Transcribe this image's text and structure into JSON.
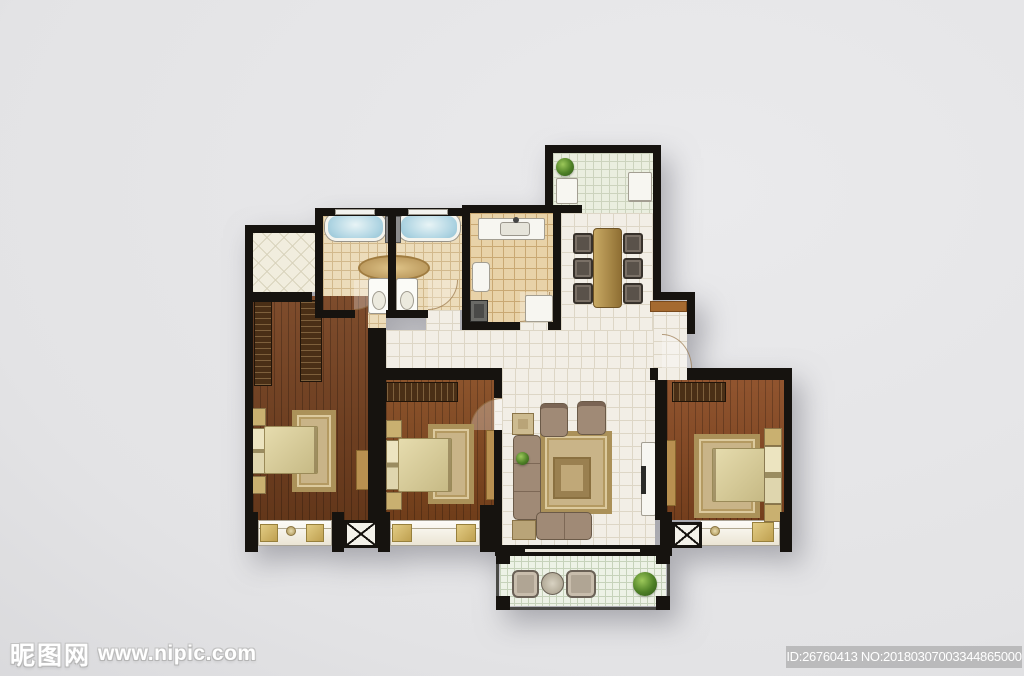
{
  "watermarks": {
    "site_name": "昵图网",
    "site_url": "www.nipic.com",
    "image_id": "ID:26760413 NO:20180307003344865000"
  },
  "colors": {
    "background": "#e4e4e6",
    "wall": "#16130f",
    "public_tile": "#f2eee6",
    "kitchen_floor": "#e8d2a8",
    "bath_floor": "#ecdcba",
    "balcony_floor": "#edf2e6",
    "wood_floor_left": "#76411f",
    "wood_floor_middle": "#85491f",
    "wood_floor_right": "#8a4a22",
    "bathtub_water": "#aed4e2",
    "rug": "#c9b488",
    "bed": "#d5c896",
    "wardrobe": "#4a2f16",
    "sofa": "#a08a76",
    "dining_table": "#b6914e",
    "plant": "#4e8026",
    "watermark_bar": "#a0a0a0"
  },
  "floorplan": {
    "rooms": [
      "entry",
      "dining-area",
      "kitchen",
      "bathroom-1",
      "bathroom-2",
      "storage-room",
      "bedroom-left",
      "bedroom-middle",
      "bedroom-right",
      "hallway",
      "living-room",
      "balcony"
    ],
    "icons": {
      "plant-icon": "green radial circle",
      "bathtub-icon": "blue rounded rect with white rim",
      "toilet-icon": "white box with oval bowl",
      "sink-icon": "white counter with basin rect",
      "bed-icon": "khaki mattress with pillow band",
      "sofa-icon": "L-shaped tan block",
      "dining-table-icon": "wood rect with six chairs",
      "ac-platform-icon": "white box with X cross",
      "door-swing-icon": "quarter-circle arc"
    }
  }
}
